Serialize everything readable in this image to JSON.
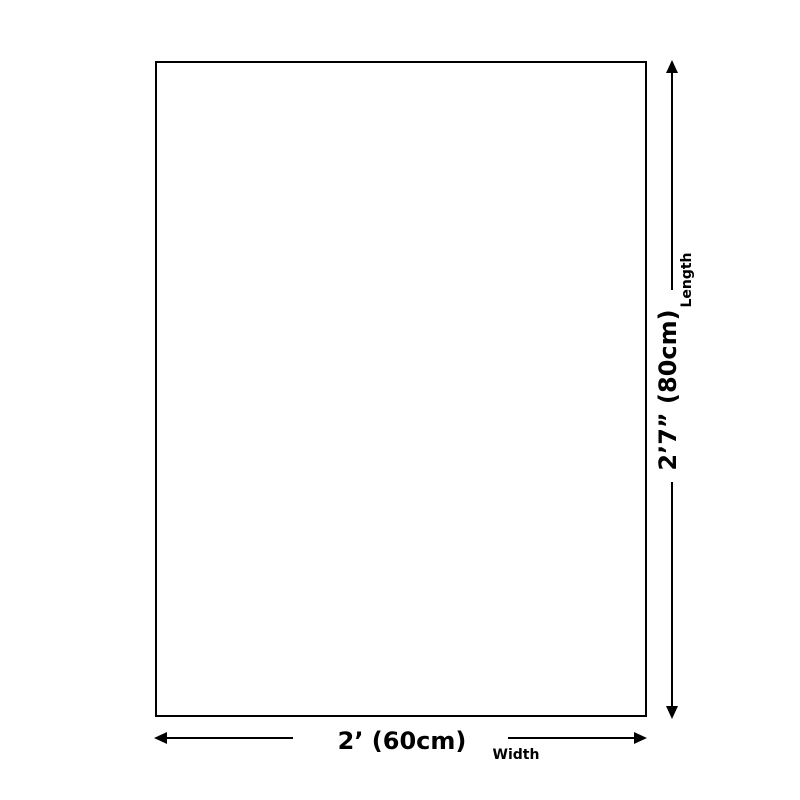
{
  "diagram": {
    "length": {
      "value": "2’7” (80cm)",
      "label": "Length"
    },
    "width": {
      "value": "2’ (60cm)",
      "label": "Width"
    },
    "colors": {
      "line": "#000000",
      "background": "#ffffff"
    }
  }
}
